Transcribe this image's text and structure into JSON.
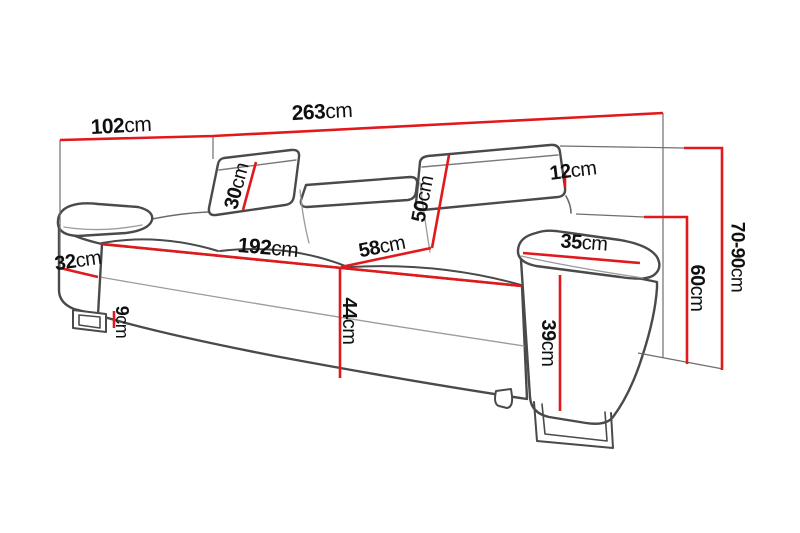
{
  "diagram": {
    "subject": "sofa-dimension-diagram",
    "unit": "cm",
    "accent_color": "#e2191c",
    "outline_color": "#4a4a4a",
    "dims": {
      "w102": {
        "value": "102",
        "unit": "cm"
      },
      "w263": {
        "value": "263",
        "unit": "cm"
      },
      "h30": {
        "value": "30",
        "unit": "cm"
      },
      "h12": {
        "value": "12",
        "unit": "cm"
      },
      "h50": {
        "value": "50",
        "unit": "cm"
      },
      "w32": {
        "value": "32",
        "unit": "cm"
      },
      "w192": {
        "value": "192",
        "unit": "cm"
      },
      "d58": {
        "value": "58",
        "unit": "cm"
      },
      "w35": {
        "value": "35",
        "unit": "cm"
      },
      "h44": {
        "value": "44",
        "unit": "cm"
      },
      "h9": {
        "value": "9",
        "unit": "cm"
      },
      "h39": {
        "value": "39",
        "unit": "cm"
      },
      "h60": {
        "value": "60",
        "unit": "cm"
      },
      "h70_90": {
        "value": "70-90",
        "unit": "cm"
      }
    }
  }
}
